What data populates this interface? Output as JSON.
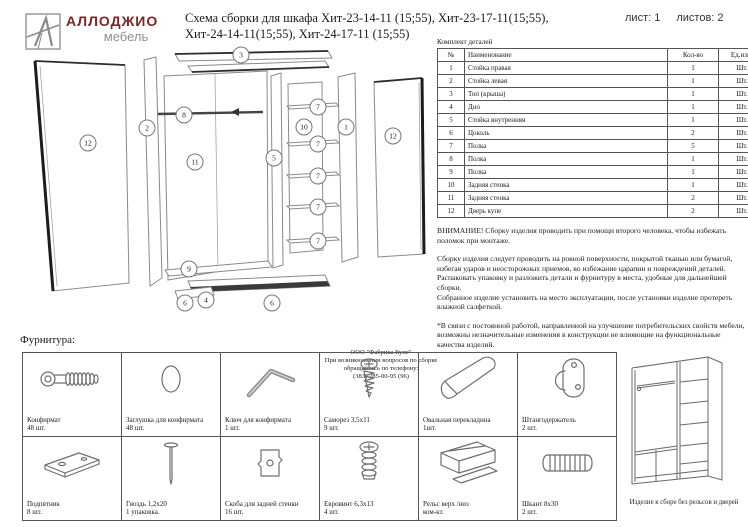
{
  "header": {
    "brand": "АЛЛОДЖИО",
    "brand_sub": "мебель",
    "brand_color": "#7d2524",
    "title_line1": "Схема сборки для шкафа Хит-23-14-11 (15;55), Хит-23-17-11(15;55),",
    "title_line2": "Хит-24-14-11(15;55), Хит-24-17-11 (15;55)",
    "sheet_label": "лист: 1",
    "sheets_label": "листов: 2"
  },
  "diagram": {
    "callouts": [
      {
        "n": "12",
        "x": 63,
        "y": 95
      },
      {
        "n": "2",
        "x": 122,
        "y": 80
      },
      {
        "n": "3",
        "x": 216,
        "y": 7
      },
      {
        "n": "8",
        "x": 159,
        "y": 67
      },
      {
        "n": "11",
        "x": 170,
        "y": 114
      },
      {
        "n": "5",
        "x": 249,
        "y": 110
      },
      {
        "n": "10",
        "x": 279,
        "y": 79
      },
      {
        "n": "7",
        "x": 293,
        "y": 59
      },
      {
        "n": "7",
        "x": 293,
        "y": 96
      },
      {
        "n": "7",
        "x": 293,
        "y": 128
      },
      {
        "n": "7",
        "x": 293,
        "y": 159
      },
      {
        "n": "7",
        "x": 293,
        "y": 193
      },
      {
        "n": "1",
        "x": 321,
        "y": 79
      },
      {
        "n": "12",
        "x": 368,
        "y": 88
      },
      {
        "n": "9",
        "x": 164,
        "y": 221
      },
      {
        "n": "6",
        "x": 160,
        "y": 255
      },
      {
        "n": "4",
        "x": 181,
        "y": 252
      },
      {
        "n": "6",
        "x": 247,
        "y": 255
      }
    ],
    "company_note_lines": [
      "ООО \"Фабрика Купе\"",
      "При возникновении вопросов по сборке",
      "обращайтесь по телефону:",
      "(383) 285-00-95 (96)"
    ]
  },
  "parts_table": {
    "caption": "Комплект деталей",
    "columns": [
      "№",
      "Наименование",
      "Кол-во",
      "Ед.изм."
    ],
    "rows": [
      [
        "1",
        "Стойка правая",
        "1",
        "Шт."
      ],
      [
        "2",
        "Стойка левая",
        "1",
        "Шт."
      ],
      [
        "3",
        "Топ (крыша)",
        "1",
        "Шт."
      ],
      [
        "4",
        "Дно",
        "1",
        "Шт."
      ],
      [
        "5",
        "Стойка внутренняя",
        "1",
        "Шт."
      ],
      [
        "6",
        "Цоколь",
        "2",
        "Шт."
      ],
      [
        "7",
        "Полка",
        "5",
        "Шт."
      ],
      [
        "8",
        "Полка",
        "1",
        "Шт."
      ],
      [
        "9",
        "Полка",
        "1",
        "Шт."
      ],
      [
        "10",
        "Задняя стенка",
        "1",
        "Шт."
      ],
      [
        "11",
        "Задняя стенка",
        "2",
        "Шт."
      ],
      [
        "12",
        "Дверь купе",
        "2",
        "Шт."
      ]
    ]
  },
  "notes": {
    "warning": "ВНИМАНИЕ! Сборку изделия проводить при помощи второго человека, чтобы избежать поломок при монтаже.",
    "paragraph2": "Сборку изделия следует проводить на ровной поверхности, покрытой тканью или бумагой, избегая ударов и неосторожных приемов, во избежание царапин и повреждений деталей.\nРаспаковать упаковку и разложить детали и фурнитуру в места, удобные для дальнейшей сборки.\nСобранное изделие установить на место эксплуатации, после установки изделие протереть влажной салфеткой.",
    "paragraph3": "*В связи с постоянной работой, направленной на улучшение потребительских свойств мебели, возможны незначительные изменения в конструкции не влияющие на функциональные качества изделий."
  },
  "hardware": {
    "caption": "Фурнитура:",
    "items": [
      {
        "name": "Конфирмат",
        "qty": "48 шт.",
        "icon": "confirmat"
      },
      {
        "name": "Заглушка для конфирмата",
        "qty": "48 шт.",
        "icon": "cap"
      },
      {
        "name": "Ключ для конфирмата",
        "qty": "1 шт.",
        "icon": "hexkey"
      },
      {
        "name": "Саморез 3,5х11",
        "qty": "9 шт.",
        "icon": "screw-small"
      },
      {
        "name": "Овальная перекладина",
        "qty": "1шт.",
        "icon": "oval-rail"
      },
      {
        "name": "Штангодержатель",
        "qty": "2 шт.",
        "icon": "rod-holder"
      },
      {
        "name": "Подпятник",
        "qty": "8 шт.",
        "icon": "foot-pad"
      },
      {
        "name": "Гвоздь 1,2х20",
        "qty": "1 упаковка.",
        "icon": "nail"
      },
      {
        "name": "Скоба для задней стенки",
        "qty": "16 шт.",
        "icon": "bracket"
      },
      {
        "name": "Евровинт 6,3х13",
        "qty": "4 шт.",
        "icon": "euro-screw"
      },
      {
        "name": "Рельс верх /низ",
        "qty": "ком-кт.",
        "icon": "rail-profile"
      },
      {
        "name": "Шкант 8х30",
        "qty": "2 шт.",
        "icon": "dowel"
      }
    ],
    "assembled_caption": "Изделие в сборе без рельсов и дверей"
  }
}
